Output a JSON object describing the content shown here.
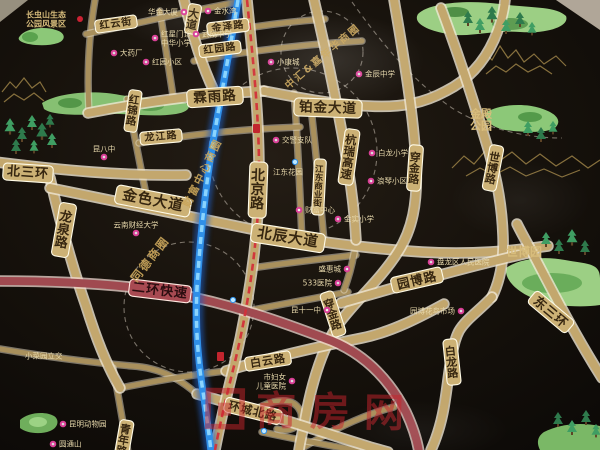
{
  "roads": {
    "beisanhuan": "北三环",
    "longquan": "龙泉路",
    "jinse": "金色大道",
    "beichen": "北辰大道",
    "beijing": "北京路",
    "linyu": "霖雨路",
    "bojin": "铂金大道",
    "hongyun": "红云街",
    "jinze": "金泽路",
    "hongyuanlu": "红园路",
    "hongjin": "红锦路",
    "longjiang": "龙江路",
    "dadao": "大道",
    "erhuan": "二环快速",
    "hangrui": "杭瑞高速",
    "chuanjin": "穿金路",
    "shibolu": "世博路",
    "dongsanhuan": "东三环",
    "yuanbolu": "园博路",
    "bailong": "白龙路",
    "baiyun": "白云路",
    "huanchengbei": "环城北路",
    "jiangdong": "江东商业街",
    "qingnian": "青年路"
  },
  "districts": {
    "tongde": "同德商圈",
    "caifu": "财富中心商圈",
    "zhonghui": "中汇&嘉年华商圈"
  },
  "parks": {
    "changchongshan": {
      "line1": "长虫山生态",
      "line2": "公园风景区"
    },
    "jindian": {
      "line1": "金殿",
      "line2": "公园"
    },
    "shiboyuan": "世博园",
    "zoo": "昆明动物园"
  },
  "pois": [
    "华金大厦",
    "金水湾",
    "红星门诊",
    "中华小学",
    "武成中学",
    "大药厂",
    "红园小区",
    "小康城",
    "金辰中学",
    "昆八中",
    "云南财经大学",
    "金实小学",
    "交警支队",
    "江东花园",
    "财富中心",
    "盛惠城",
    "533医院",
    "昆十一中",
    "盘龙区人民医院",
    "园博花鸟市场",
    "白龙小学",
    "浪琴小区",
    "市妇女",
    "儿童医院",
    "小菜园立交",
    "圆通山"
  ],
  "watermark": {
    "brand": "商房网"
  },
  "colors": {
    "road_gold": "#c3a76d",
    "expressway_red": "#a04a50",
    "river_blue": "#2f8fe8",
    "metro_red": "#d2303a",
    "district_fill": "#78483e",
    "park_green": "#8cc878",
    "poi_pink": "#d93f96",
    "gold_text": "#c9a55a",
    "watermark_red": "#c8232c"
  }
}
